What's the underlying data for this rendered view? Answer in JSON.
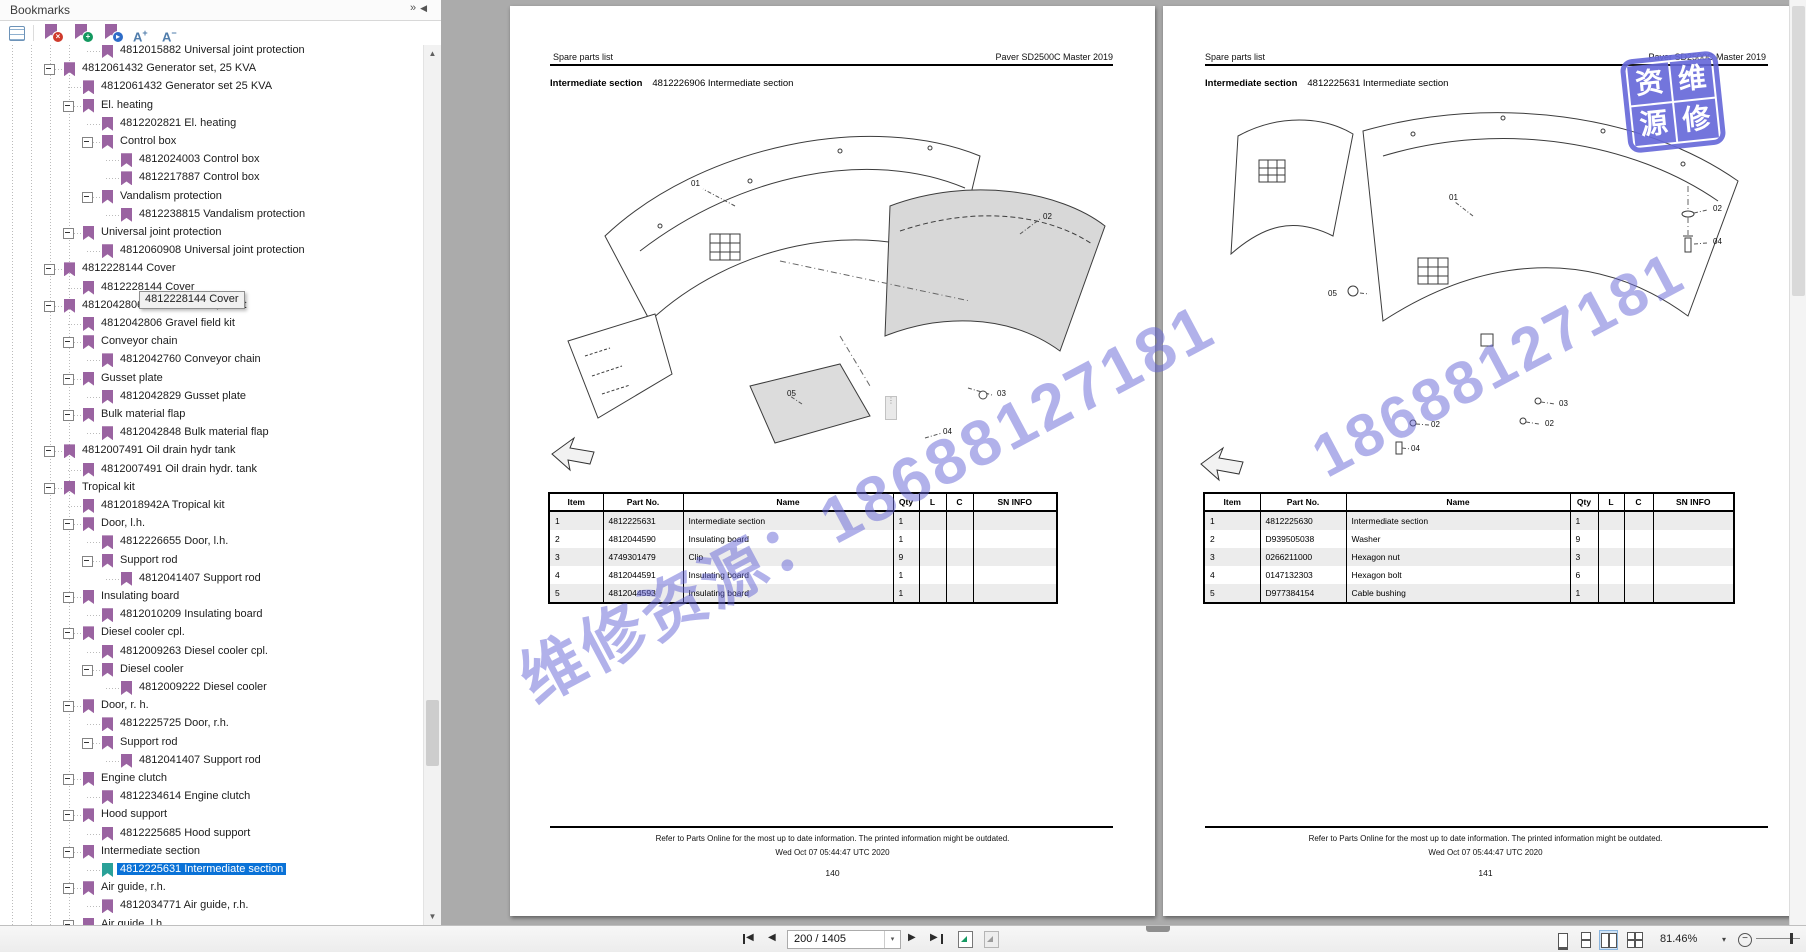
{
  "sidebar": {
    "title": "Bookmarks",
    "header_icons": {
      "expand_glyph": "»",
      "collapse_glyph": "◀"
    },
    "toolbar": {
      "icons": [
        "options-icon",
        "delete-bookmark-icon",
        "add-bookmark-icon",
        "locate-bookmark-icon",
        "font-increase-icon",
        "font-decrease-icon"
      ],
      "font_increase_label": "A",
      "font_increase_sign": "+",
      "font_decrease_label": "A",
      "font_decrease_sign": "−",
      "delete_badge": "×",
      "add_badge": "+",
      "locate_badge": "▸"
    },
    "tooltip": "4812228144 Cover",
    "tree": [
      {
        "label": "4812015882 Universal joint protection",
        "lvl": 4,
        "kind": "f"
      },
      {
        "label": "4812061432 Generator set, 25 KVA",
        "lvl": 2,
        "kind": "b"
      },
      {
        "label": "4812061432 Generator set 25 KVA",
        "lvl": 3,
        "kind": "f"
      },
      {
        "label": "El. heating",
        "lvl": 3,
        "kind": "b"
      },
      {
        "label": "4812202821 El. heating",
        "lvl": 4,
        "kind": "f"
      },
      {
        "label": "Control box",
        "lvl": 4,
        "kind": "b"
      },
      {
        "label": "4812024003 Control box",
        "lvl": 5,
        "kind": "f"
      },
      {
        "label": "4812217887 Control box",
        "lvl": 5,
        "kind": "f"
      },
      {
        "label": "Vandalism protection",
        "lvl": 4,
        "kind": "b"
      },
      {
        "label": "4812238815 Vandalism protection",
        "lvl": 5,
        "kind": "f"
      },
      {
        "label": "Universal joint protection",
        "lvl": 3,
        "kind": "b"
      },
      {
        "label": "4812060908 Universal joint protection",
        "lvl": 4,
        "kind": "f"
      },
      {
        "label": "4812228144 Cover",
        "lvl": 2,
        "kind": "b"
      },
      {
        "label": "4812228144 Cover",
        "lvl": 3,
        "kind": "f"
      },
      {
        "label": "4812042806 Gravel field kit, short",
        "lvl": 2,
        "kind": "b"
      },
      {
        "label": "4812042806 Gravel field kit",
        "lvl": 3,
        "kind": "f"
      },
      {
        "label": "Conveyor chain",
        "lvl": 3,
        "kind": "b"
      },
      {
        "label": "4812042760 Conveyor chain",
        "lvl": 4,
        "kind": "f"
      },
      {
        "label": "Gusset plate",
        "lvl": 3,
        "kind": "b"
      },
      {
        "label": "4812042829 Gusset plate",
        "lvl": 4,
        "kind": "f"
      },
      {
        "label": "Bulk material flap",
        "lvl": 3,
        "kind": "b"
      },
      {
        "label": "4812042848 Bulk material flap",
        "lvl": 4,
        "kind": "f"
      },
      {
        "label": "4812007491 Oil drain hydr tank",
        "lvl": 2,
        "kind": "b"
      },
      {
        "label": "4812007491 Oil drain hydr. tank",
        "lvl": 3,
        "kind": "f"
      },
      {
        "label": "Tropical kit",
        "lvl": 2,
        "kind": "b"
      },
      {
        "label": "4812018942A Tropical kit",
        "lvl": 3,
        "kind": "f"
      },
      {
        "label": "Door, l.h.",
        "lvl": 3,
        "kind": "b"
      },
      {
        "label": "4812226655 Door, l.h.",
        "lvl": 4,
        "kind": "f"
      },
      {
        "label": "Support rod",
        "lvl": 4,
        "kind": "b"
      },
      {
        "label": "4812041407 Support rod",
        "lvl": 5,
        "kind": "f"
      },
      {
        "label": "Insulating board",
        "lvl": 3,
        "kind": "b"
      },
      {
        "label": "4812010209 Insulating board",
        "lvl": 4,
        "kind": "f"
      },
      {
        "label": "Diesel cooler cpl.",
        "lvl": 3,
        "kind": "b"
      },
      {
        "label": "4812009263 Diesel cooler cpl.",
        "lvl": 4,
        "kind": "f"
      },
      {
        "label": "Diesel cooler",
        "lvl": 4,
        "kind": "b"
      },
      {
        "label": "4812009222 Diesel cooler",
        "lvl": 5,
        "kind": "f"
      },
      {
        "label": "Door, r. h.",
        "lvl": 3,
        "kind": "b"
      },
      {
        "label": "4812225725 Door, r.h.",
        "lvl": 4,
        "kind": "f"
      },
      {
        "label": "Support rod",
        "lvl": 4,
        "kind": "b"
      },
      {
        "label": "4812041407 Support rod",
        "lvl": 5,
        "kind": "f"
      },
      {
        "label": "Engine clutch",
        "lvl": 3,
        "kind": "b"
      },
      {
        "label": "4812234614 Engine clutch",
        "lvl": 4,
        "kind": "f"
      },
      {
        "label": "Hood support",
        "lvl": 3,
        "kind": "b"
      },
      {
        "label": "4812225685 Hood support",
        "lvl": 4,
        "kind": "f"
      },
      {
        "label": "Intermediate section",
        "lvl": 3,
        "kind": "b"
      },
      {
        "label": "4812225631 Intermediate section",
        "lvl": 4,
        "kind": "f",
        "sel": true
      },
      {
        "label": "Air guide, r.h.",
        "lvl": 3,
        "kind": "b"
      },
      {
        "label": "4812034771 Air guide, r.h.",
        "lvl": 4,
        "kind": "f"
      },
      {
        "label": "Air guide, l.h",
        "lvl": 3,
        "kind": "b"
      }
    ]
  },
  "pages": [
    {
      "header_left": "Spare parts list",
      "header_right": "Paver SD2500C Master 2019",
      "title_bold": "Intermediate section",
      "title_rest": "4812226906 Intermediate section",
      "callouts": [
        "01",
        "02",
        "05",
        "03",
        "04"
      ],
      "table": {
        "headers": [
          "Item",
          "Part No.",
          "Name",
          "Qty",
          "L",
          "C",
          "SN INFO"
        ],
        "rows": [
          [
            "1",
            "4812225631",
            "Intermediate section",
            "1"
          ],
          [
            "2",
            "4812044590",
            "Insulating board",
            "1"
          ],
          [
            "3",
            "4749301479",
            "Clip",
            "9"
          ],
          [
            "4",
            "4812044591",
            "Insulating board",
            "1"
          ],
          [
            "5",
            "4812044593",
            "Insulating board",
            "1"
          ]
        ]
      },
      "footer_line1": "Refer to Parts Online for the most up to date information. The printed information might be outdated.",
      "footer_line2": "Wed Oct 07 05:44:47 UTC 2020",
      "page_number": "140"
    },
    {
      "header_left": "Spare parts list",
      "header_right": "Paver SD2500C Master 2019",
      "title_bold": "Intermediate section",
      "title_rest": "4812225631 Intermediate section",
      "callouts": [
        "01",
        "02",
        "04",
        "05",
        "03",
        "02",
        "02",
        "04"
      ],
      "table": {
        "headers": [
          "Item",
          "Part No.",
          "Name",
          "Qty",
          "L",
          "C",
          "SN INFO"
        ],
        "rows": [
          [
            "1",
            "4812225630",
            "Intermediate section",
            "1"
          ],
          [
            "2",
            "D939505038",
            "Washer",
            "9"
          ],
          [
            "3",
            "0266211000",
            "Hexagon nut",
            "3"
          ],
          [
            "4",
            "0147132303",
            "Hexagon bolt",
            "6"
          ],
          [
            "5",
            "D977384154",
            "Cable bushing",
            "1"
          ]
        ]
      },
      "footer_line1": "Refer to Parts Online for the most up to date information. The printed information might be outdated.",
      "footer_line2": "Wed Oct 07 05:44:47 UTC 2020",
      "page_number": "141"
    }
  ],
  "watermark": {
    "text1": "维修资源：18688127181",
    "text2": "18688127181",
    "color": "#6464d6"
  },
  "stamp": {
    "chars": [
      "资",
      "维",
      "源",
      "修"
    ],
    "color": "#6666d8"
  },
  "bottom_toolbar": {
    "icons": [
      "first-page-icon",
      "previous-page-icon",
      "next-page-icon",
      "last-page-icon",
      "open-new-tab-icon",
      "open-new-window-icon",
      "single-page-icon",
      "continuous-page-icon",
      "facing-pages-icon",
      "continuous-facing-icon",
      "zoom-out-icon",
      "zoom-slider"
    ],
    "page_input": "200 / 1405",
    "zoom_level": "81.46%",
    "glyphs": {
      "prev": "◀",
      "next": "▶",
      "up": "▲",
      "down": "▼",
      "dd": "▾"
    }
  },
  "accent_colors": {
    "selection_blue": "#0a72d7",
    "bookmark_purple": "#9a63a1",
    "selected_bookmark_teal": "#2aa198",
    "canvas_gray": "#ababab"
  }
}
